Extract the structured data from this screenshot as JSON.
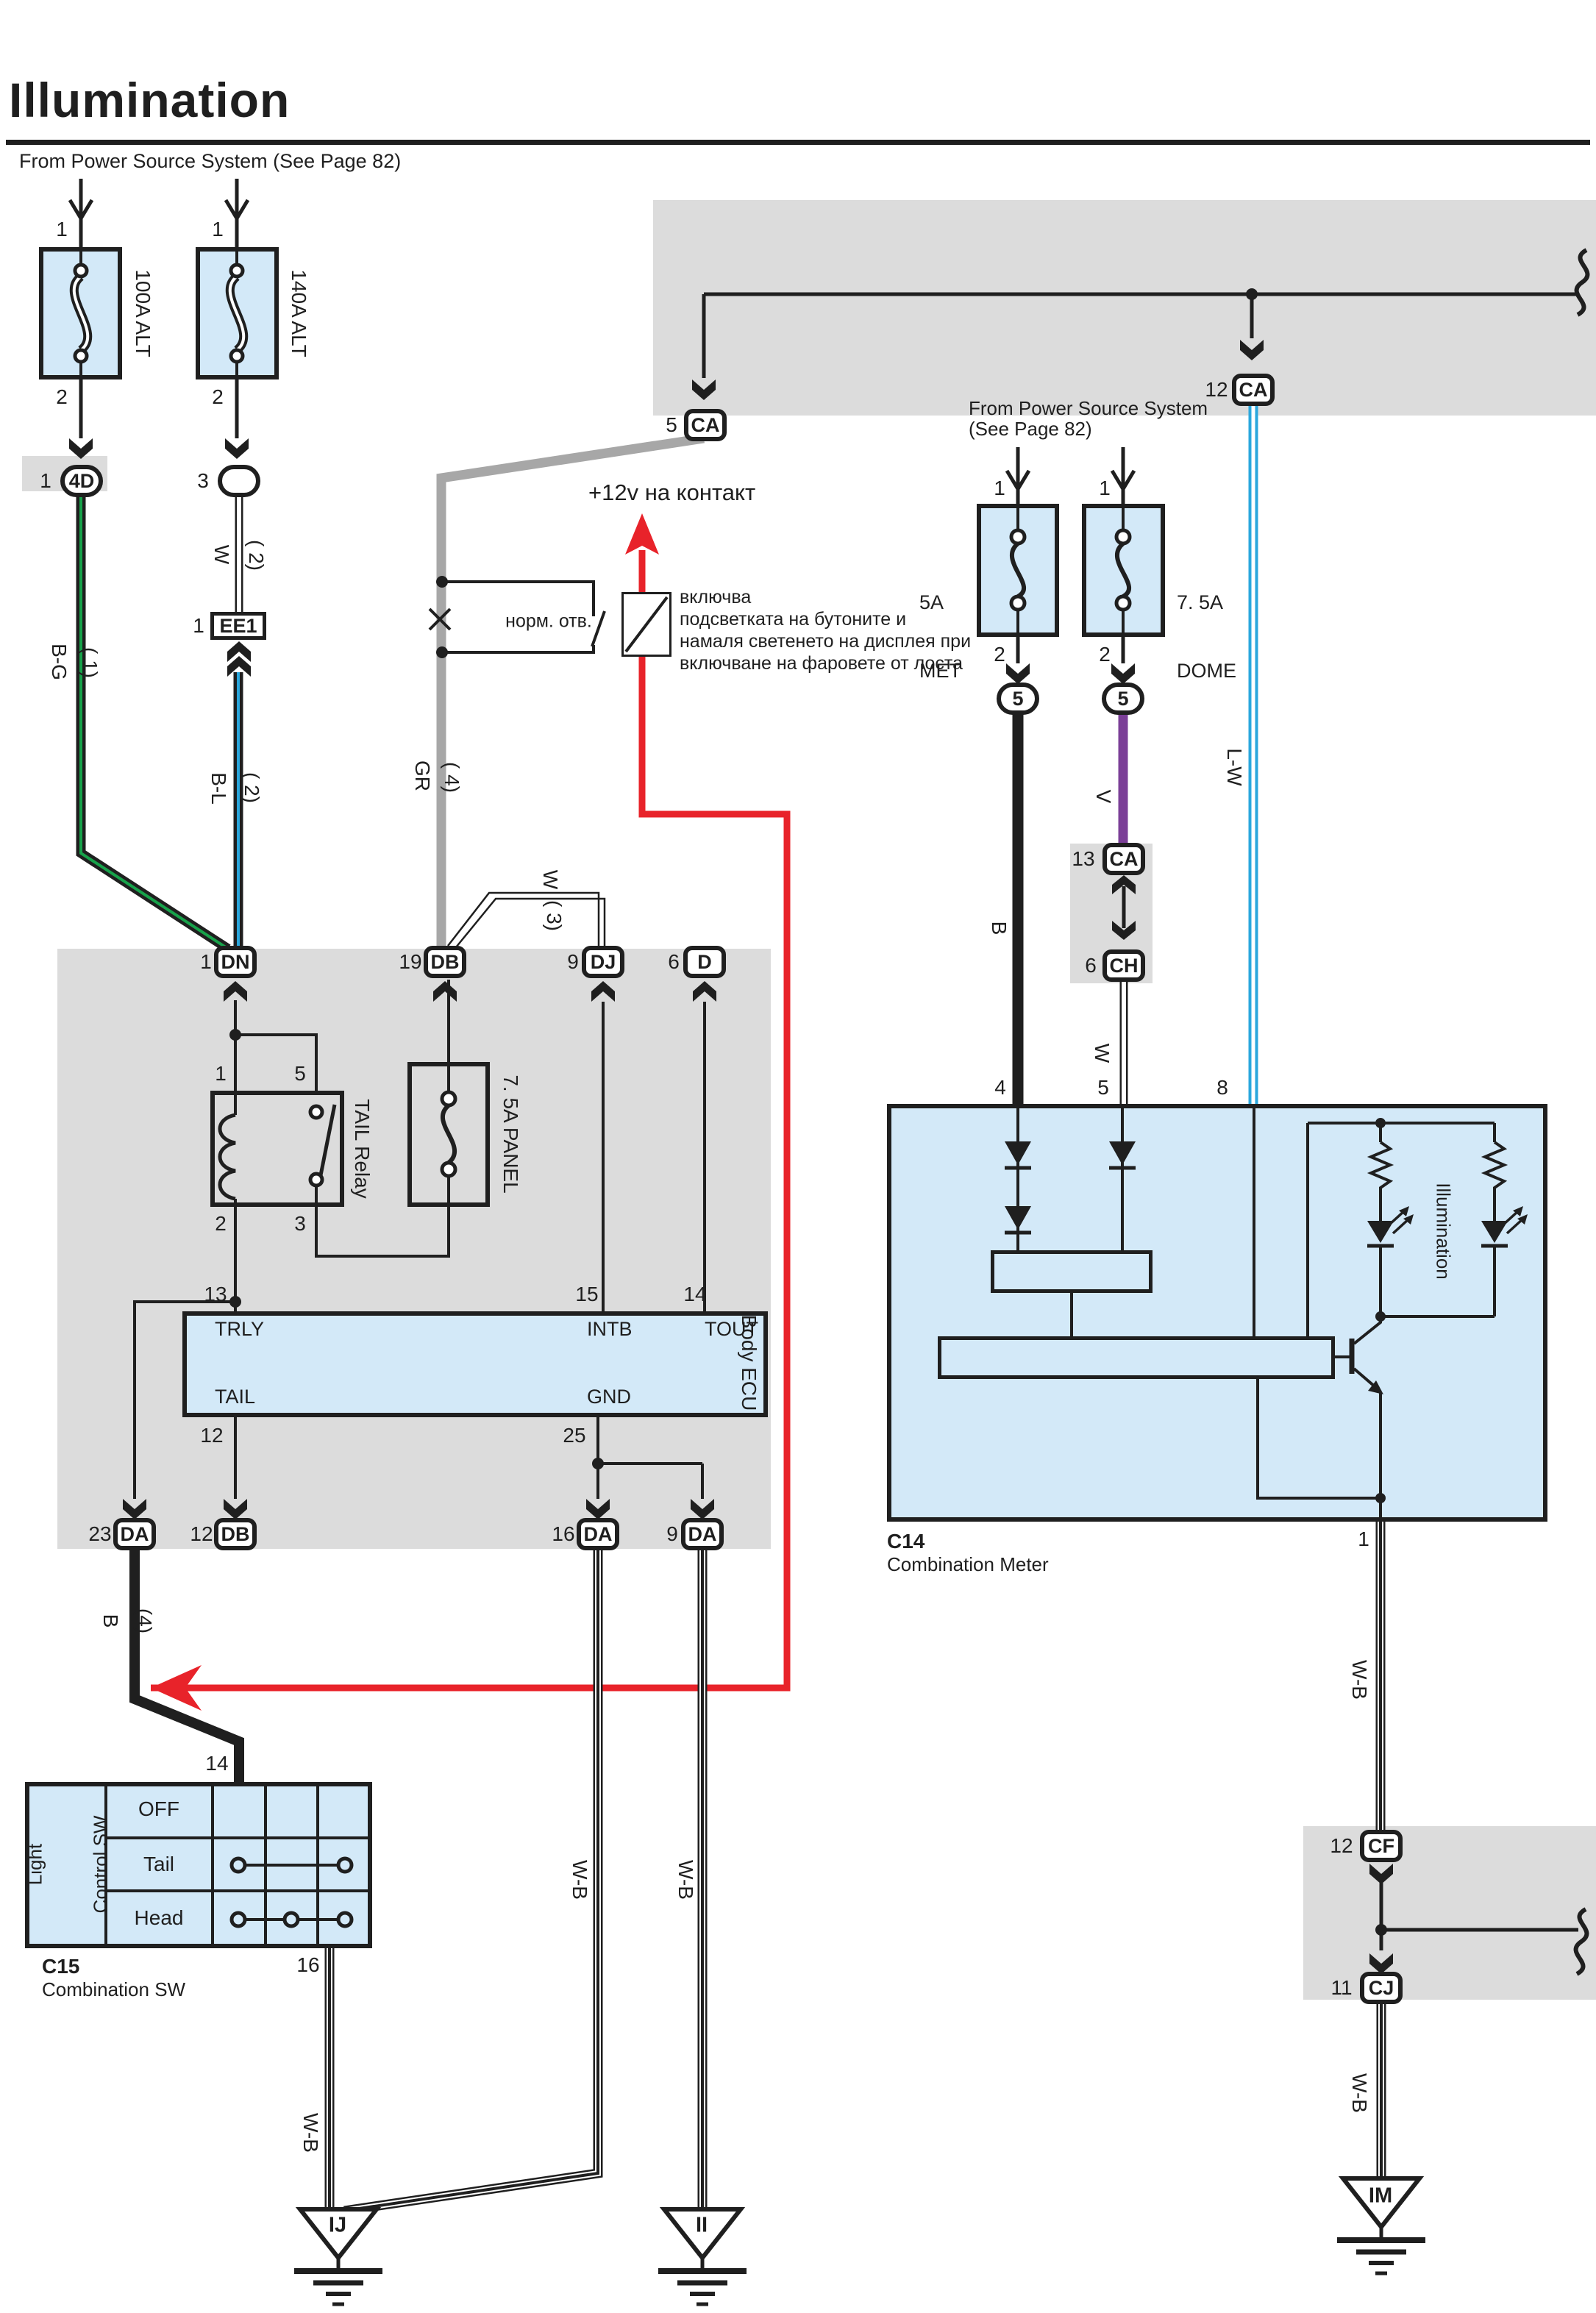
{
  "title": "Illumination",
  "subtitle": "From Power Source System (See Page 82)",
  "power_note": {
    "line1": "From Power Source System",
    "line2": "(See Page 82)"
  },
  "notes": {
    "plus12v": "+12v на контакт",
    "normally_open": "норм. отв."
  },
  "annotation": {
    "line1": "включва",
    "line2": "подсветката на бутоните и",
    "line3": "намаля светенето на дисплея при",
    "line4": "включване на фаровете от лоста"
  },
  "components": {
    "alt100": {
      "label": "100A ALT",
      "pin1": "1",
      "pin2": "2"
    },
    "alt140": {
      "label": "140A ALT",
      "pin1": "1",
      "pin2": "2"
    },
    "met": {
      "line1": "5A",
      "line2": "MET",
      "pin1": "1",
      "pin2": "2"
    },
    "dome": {
      "line1": "7. 5A",
      "line2": "DOME",
      "pin1": "1",
      "pin2": "2"
    },
    "panel": {
      "label": "7. 5A PANEL"
    },
    "relay": {
      "label": "TAIL Relay",
      "p1": "1",
      "p5": "5",
      "p2": "2",
      "p3": "3"
    },
    "ecu": {
      "label": "Body ECU",
      "trly": "TRLY",
      "intb": "INTB",
      "tout": "TOUT",
      "tail": "TAIL",
      "gnd": "GND",
      "p13": "13",
      "p15": "15",
      "p14": "14",
      "p12": "12",
      "p25": "25"
    },
    "c14": {
      "id": "C14",
      "name": "Combination Meter",
      "p4": "4",
      "p5": "5",
      "p8": "8",
      "p1": "1",
      "illum": "Illumination"
    },
    "c15": {
      "id": "C15",
      "name": "Combination SW",
      "side1": "Light",
      "side2": "Control SW",
      "off": "OFF",
      "tail": "Tail",
      "head": "Head",
      "p14": "14",
      "p16": "16"
    }
  },
  "connectors": {
    "c4d": {
      "pin": "1",
      "code": "4D"
    },
    "c3": {
      "pin": "3",
      "code": ""
    },
    "ee1": {
      "pin": "1",
      "code": "EE1"
    },
    "dn": {
      "pin": "1",
      "code": "DN"
    },
    "db": {
      "pin": "19",
      "code": "DB"
    },
    "dj": {
      "pin": "9",
      "code": "DJ"
    },
    "dd": {
      "pin": "6",
      "code": "D"
    },
    "ca5": {
      "pin": "5",
      "code": "CA"
    },
    "ca12": {
      "pin": "12",
      "code": "CA"
    },
    "ca13": {
      "pin": "13",
      "code": "CA"
    },
    "ch6": {
      "pin": "6",
      "code": "CH"
    },
    "f5l": {
      "code": "5"
    },
    "f5r": {
      "code": "5"
    },
    "da23": {
      "pin": "23",
      "code": "DA"
    },
    "db12": {
      "pin": "12",
      "code": "DB"
    },
    "da16": {
      "pin": "16",
      "code": "DA"
    },
    "da9": {
      "pin": "9",
      "code": "DA"
    },
    "cf": {
      "pin": "12",
      "code": "CF"
    },
    "cj": {
      "pin": "11",
      "code": "CJ"
    }
  },
  "wires": {
    "bg": "B-G",
    "bg_g": "( 1)",
    "w2": "W",
    "w2_g": "( 2)",
    "bl": "B-L",
    "bl_g": "( 2)",
    "gr": "GR",
    "gr_g": "( 4)",
    "w3": "W",
    "w3_g": "( 3)",
    "b": "B",
    "v": "V",
    "w": "W",
    "lw": "L-W",
    "b4": "B",
    "b4_g": "(4)",
    "wb": "W-B"
  },
  "grounds": {
    "ij": "IJ",
    "ii": "II",
    "im": "IM"
  },
  "colors": {
    "green": "#17a24a",
    "blue": "#2aa7dd",
    "purple": "#7b3f97",
    "red": "#e8232a",
    "gray_wire": "#a7a7a7",
    "band": "#dcdcdc",
    "panel": "#d3e9f8"
  }
}
